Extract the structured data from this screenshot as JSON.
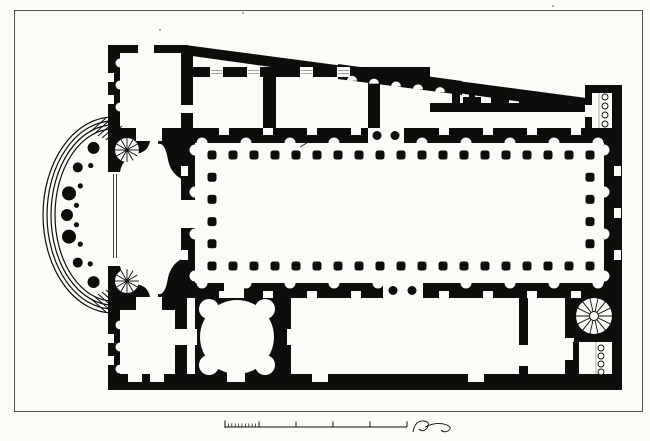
{
  "title": "Architectural floor plan engraving",
  "colors": {
    "ink": "#0e0d0b",
    "paper": "#fcfbf8",
    "frame": "#57534c",
    "faint": "#8f8b84"
  },
  "frame": {
    "x": 14.5,
    "y": 10.5,
    "w": 628,
    "h": 401
  },
  "plan": {
    "walls": [
      [
        108,
        45,
        12,
        84
      ],
      [
        108,
        308,
        12,
        82
      ],
      [
        108,
        45,
        80,
        8
      ],
      [
        181,
        53,
        12,
        52
      ],
      [
        181,
        113,
        12,
        17
      ],
      [
        108,
        128,
        76,
        13
      ],
      [
        108,
        297,
        76,
        13
      ],
      [
        181,
        128,
        431,
        15
      ],
      [
        181,
        283,
        431,
        15
      ],
      [
        181,
        143,
        14,
        140
      ],
      [
        604,
        143,
        18,
        140
      ],
      [
        612,
        85,
        10,
        305
      ],
      [
        108,
        374,
        514,
        16
      ],
      [
        190,
        67,
        240,
        10
      ],
      [
        263,
        77,
        13,
        51
      ],
      [
        368,
        77,
        12,
        51
      ],
      [
        430,
        103,
        182,
        9
      ],
      [
        452,
        84,
        8,
        21
      ],
      [
        585,
        85,
        37,
        8
      ],
      [
        585,
        85,
        7,
        22
      ],
      [
        585,
        117,
        7,
        19
      ],
      [
        195,
        298,
        96,
        78
      ],
      [
        519,
        298,
        9,
        47
      ],
      [
        519,
        366,
        9,
        10
      ],
      [
        565,
        298,
        9,
        40
      ],
      [
        565,
        360,
        9,
        16
      ],
      [
        574,
        294,
        38,
        48
      ],
      [
        573,
        342,
        6,
        32
      ],
      [
        175,
        310,
        12,
        66
      ]
    ],
    "polys": [
      "185,45 594,99 594,112 185,55",
      "338,64 462,81 462,95 338,79"
    ],
    "pier_paths": [
      "M108,128 L150,128 Q153,149 140,153 Q122,158 120,172 L108,172 Z",
      "M108,310 L150,310 Q153,289 140,285 Q122,280 120,266 L108,266 Z",
      "M158,128 L195,128 L195,183 Q172,180 168,160 Q165,142 158,144 Z",
      "M158,310 L195,310 L195,255 Q172,258 168,278 Q165,296 158,294 Z"
    ],
    "white_rects": [
      [
        136,
        128,
        26,
        13
      ],
      [
        136,
        297,
        26,
        13
      ],
      [
        368,
        128,
        36,
        15
      ],
      [
        383,
        283,
        40,
        15
      ],
      [
        592,
        93,
        20,
        35
      ],
      [
        585,
        105,
        7,
        12
      ],
      [
        183,
        329,
        14,
        16
      ],
      [
        287,
        329,
        10,
        16
      ],
      [
        227,
        370,
        18,
        12
      ],
      [
        224,
        283,
        20,
        15
      ],
      [
        579,
        342,
        29,
        32
      ],
      [
        175,
        329,
        12,
        16
      ],
      [
        187,
        298,
        8,
        12
      ],
      [
        181,
        200,
        14,
        28
      ],
      [
        138,
        45,
        16,
        8
      ],
      [
        128,
        374,
        14,
        8
      ],
      [
        150,
        374,
        14,
        8
      ],
      [
        312,
        374,
        16,
        8
      ],
      [
        468,
        374,
        16,
        8
      ]
    ],
    "diag": {
      "x0": 185,
      "y0": 45,
      "x1": 594,
      "y1": 99
    },
    "scallops": {
      "xs": [
        352,
        374,
        396,
        418,
        440
      ],
      "r": 5,
      "ex0": 338,
      "ey0": 79,
      "ex1": 462,
      "ey1": 95
    },
    "t_piers": {
      "xs": [
        472,
        500,
        528,
        556
      ],
      "stem_w": 6,
      "foot_w": 18,
      "foot_y": 97,
      "foot_h": 6,
      "wall_y": 103
    },
    "thresholds": {
      "y": 67,
      "h": 10,
      "w": 13,
      "xs": [
        210,
        247,
        300,
        337
      ]
    },
    "niche_bands": [
      {
        "axis": "x",
        "from": 202,
        "to": 598,
        "step": 22,
        "edge": 143,
        "rect_edge": 128,
        "dir": "up",
        "skip": [
          360,
          412
        ]
      },
      {
        "axis": "x",
        "from": 202,
        "to": 598,
        "step": 22,
        "edge": 283,
        "rect_edge": 291,
        "dir": "down",
        "skip": [
          379,
          427
        ]
      },
      {
        "axis": "y",
        "from": 150,
        "to": 276,
        "step": 21,
        "edge": 195,
        "rect_edge": 181,
        "dir": "left",
        "skip": [
          198,
          230
        ]
      },
      {
        "axis": "y",
        "from": 150,
        "to": 276,
        "step": 21,
        "edge": 604,
        "rect_edge": 614,
        "dir": "right",
        "skip": []
      }
    ],
    "west_niches": {
      "edge": 120,
      "ys": [
        63,
        85,
        107,
        325,
        347,
        369
      ],
      "r": 4.5,
      "windows": [
        [
          108,
          73,
          6,
          9
        ],
        [
          108,
          95,
          6,
          9
        ],
        [
          108,
          334,
          6,
          9
        ],
        [
          108,
          356,
          6,
          9
        ]
      ]
    },
    "colonnade": {
      "x0": 212,
      "x1": 590,
      "y0": 155,
      "y1": 266,
      "nx": 19,
      "ny": 6,
      "size": 9,
      "rx": 2.5
    },
    "entrance_columns": {
      "r": 4.5,
      "pts": [
        [
          377,
          135.5
        ],
        [
          395,
          135.5
        ],
        [
          393,
          290.5
        ],
        [
          412,
          290.5
        ]
      ]
    },
    "exedra": {
      "cx": 113,
      "cy": 215,
      "steps": [
        [
          58,
          86
        ],
        [
          62,
          90
        ],
        [
          66,
          94
        ],
        [
          70,
          98
        ]
      ],
      "pier_rx": 46,
      "pier_ry": 74,
      "piers": [
        [
          115,
          6
        ],
        [
          140,
          5
        ],
        [
          163,
          7
        ],
        [
          180,
          6
        ],
        [
          197,
          7
        ],
        [
          220,
          5
        ],
        [
          245,
          6
        ]
      ],
      "dots": [
        127,
        152,
        171,
        189,
        208,
        232
      ],
      "dot_r": 2.6,
      "mouth_lines": {
        "xs": [
          113.5,
          116.5
        ],
        "y0": 174,
        "y1": 258
      },
      "hatch_top": [
        [
          90,
          132,
          106,
          118
        ],
        [
          94,
          134,
          110,
          120
        ],
        [
          98,
          136,
          114,
          122
        ],
        [
          102,
          138,
          118,
          124
        ],
        [
          106,
          140,
          122,
          126
        ]
      ],
      "hatch_bottom": [
        [
          90,
          298,
          106,
          312
        ],
        [
          94,
          296,
          110,
          310
        ],
        [
          98,
          294,
          114,
          308
        ],
        [
          102,
          292,
          118,
          306
        ],
        [
          106,
          290,
          122,
          304
        ]
      ]
    },
    "spirals": [
      {
        "cx": 127,
        "cy": 150,
        "r": 12,
        "n": 12,
        "hub": 1.6
      },
      {
        "cx": 127,
        "cy": 281,
        "r": 12,
        "n": 12,
        "hub": 1.6
      },
      {
        "cx": 594,
        "cy": 316,
        "r": 18,
        "n": 14,
        "hub": 4.5
      }
    ],
    "rotunda": {
      "cx": 237,
      "cy": 337,
      "r": 37,
      "nr": 10,
      "niches": [
        [
          209,
          309
        ],
        [
          265,
          309
        ],
        [
          209,
          365
        ],
        [
          265,
          365
        ]
      ]
    },
    "circle_rows": [
      {
        "cx": 605,
        "ys": [
          97,
          106,
          115,
          124
        ],
        "r": 3,
        "lx": 599,
        "ly0": 93,
        "ly1": 128
      },
      {
        "cx": 601,
        "ys": [
          348,
          356,
          364,
          372
        ],
        "r": 3,
        "lx": 596,
        "ly0": 342,
        "ly1": 374
      }
    ],
    "scale_bar": {
      "y": 427,
      "x0": 225,
      "x1": 407,
      "fine_to": 259,
      "fine_step": 3.4,
      "fine_h": 3.5,
      "majors": [
        259,
        296,
        333,
        370,
        407
      ],
      "tick_h": 5.5
    },
    "signature_path": "M413,432 q2,-12 11,-11 q7,1 3,7 q-4,5 -8,1 m6,-2 q12,-6 22,-2 q6,3 1,6 q-4,2 -7,-1",
    "stray_marks": [
      "M300,147 l10,-6 l-5,1"
    ],
    "specks": [
      [
        243,
        13
      ],
      [
        553,
        6
      ],
      [
        160,
        30
      ]
    ]
  }
}
